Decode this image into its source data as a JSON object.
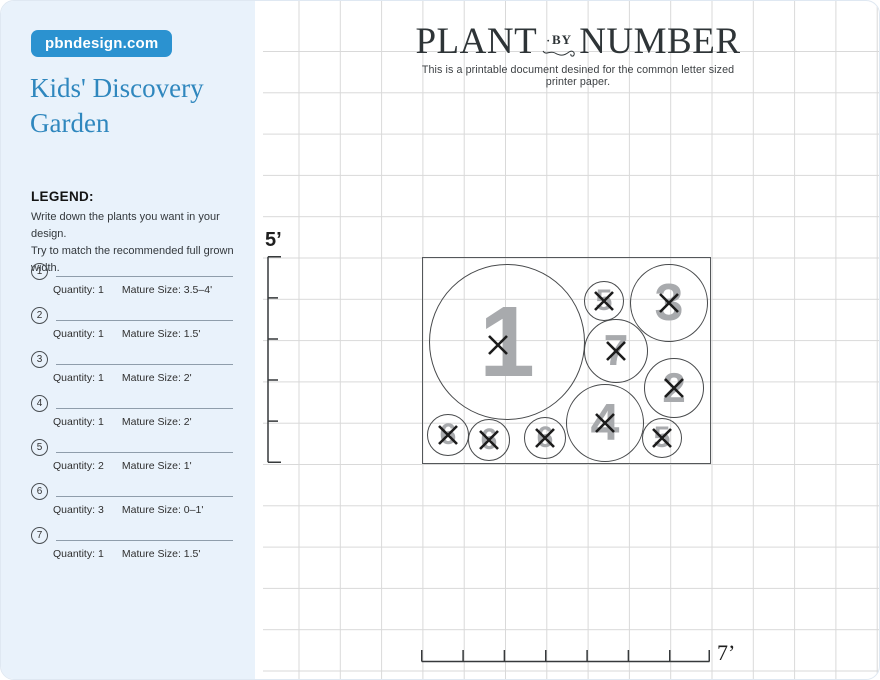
{
  "site_badge": "pbndesign.com",
  "sidebar": {
    "title": "Kids' Discovery Garden",
    "legend_heading": "LEGEND:",
    "legend_desc_line1": "Write down the plants you want in your design.",
    "legend_desc_line2": "Try to match the recommended full grown width.",
    "quantity_label": "Quantity:",
    "mature_label": "Mature Size:",
    "items": [
      {
        "num": "1",
        "quantity": "1",
        "size": "3.5–4'"
      },
      {
        "num": "2",
        "quantity": "1",
        "size": "1.5'"
      },
      {
        "num": "3",
        "quantity": "1",
        "size": "2'"
      },
      {
        "num": "4",
        "quantity": "1",
        "size": "2'"
      },
      {
        "num": "5",
        "quantity": "2",
        "size": "1'"
      },
      {
        "num": "6",
        "quantity": "3",
        "size": "0–1'"
      },
      {
        "num": "7",
        "quantity": "1",
        "size": "1.5'"
      }
    ]
  },
  "header": {
    "title_left": "PLANT",
    "title_mid": "BY",
    "title_right": "NUMBER",
    "subtitle": "This is a printable document desined for the common letter sized printer paper."
  },
  "plan": {
    "height_label": "5’",
    "width_label": "7’",
    "circles": [
      {
        "num": "1",
        "cx": 84,
        "cy": 84,
        "r": 78,
        "fs": 100
      },
      {
        "num": "5",
        "cx": 181,
        "cy": 43,
        "r": 20,
        "fs": 30
      },
      {
        "num": "3",
        "cx": 246,
        "cy": 45,
        "r": 39,
        "fs": 52
      },
      {
        "num": "7",
        "cx": 193,
        "cy": 93,
        "r": 32,
        "fs": 44
      },
      {
        "num": "2",
        "cx": 251,
        "cy": 130,
        "r": 30,
        "fs": 42
      },
      {
        "num": "4",
        "cx": 182,
        "cy": 165,
        "r": 39,
        "fs": 52
      },
      {
        "num": "5",
        "cx": 239,
        "cy": 180,
        "r": 20,
        "fs": 30
      },
      {
        "num": "6",
        "cx": 25,
        "cy": 177,
        "r": 21,
        "fs": 30
      },
      {
        "num": "6",
        "cx": 66,
        "cy": 182,
        "r": 21,
        "fs": 30
      },
      {
        "num": "6",
        "cx": 122,
        "cy": 180,
        "r": 21,
        "fs": 30
      }
    ]
  },
  "colors": {
    "sidebar_bg": "#e9f2fb",
    "badge_blue": "#2b92d0",
    "title_blue": "#2f87be",
    "grid_line": "#d9d9d9",
    "plot_border": "#54575a",
    "circle_number_gray": "#a8aaad",
    "x_mark": "#1c1c1c"
  }
}
